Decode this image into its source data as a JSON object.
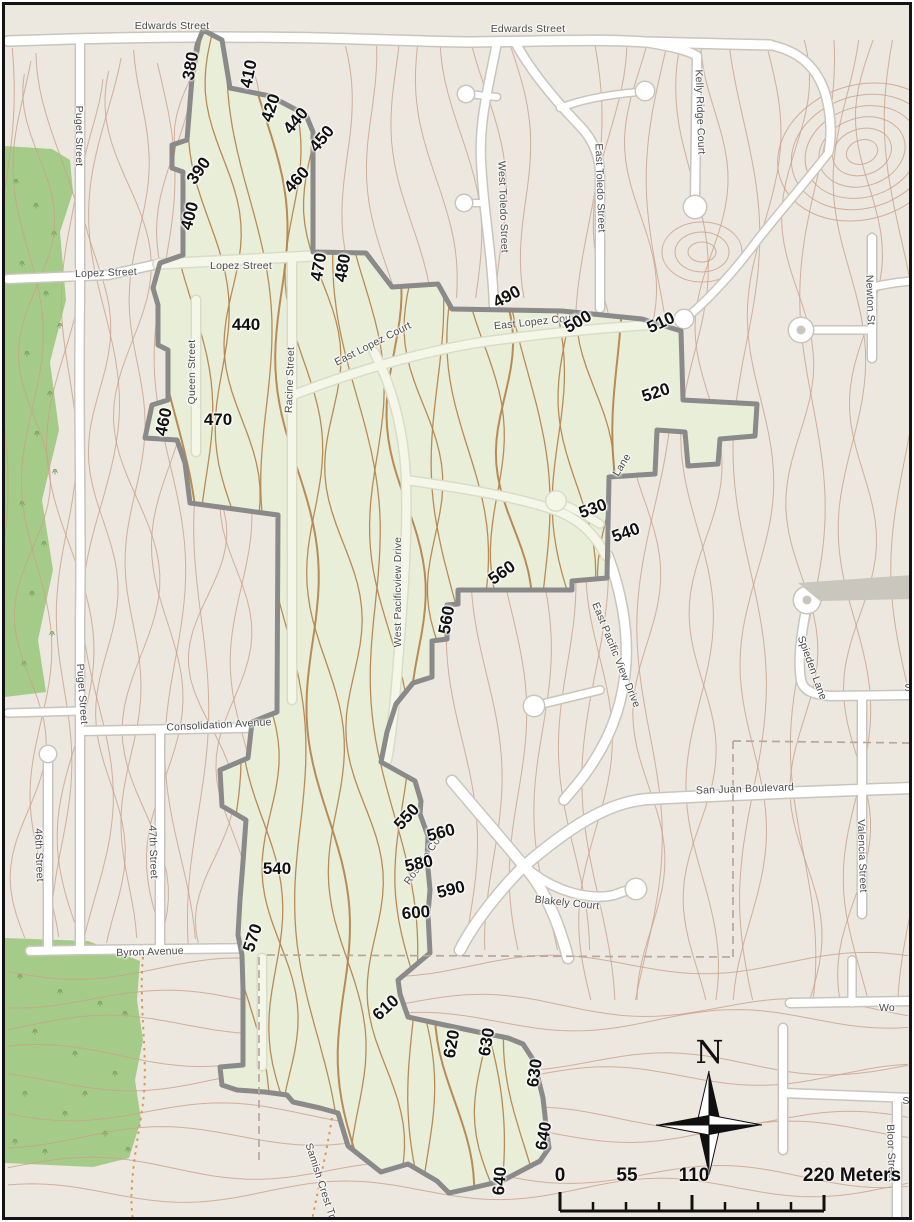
{
  "north_arrow": {
    "label": "N"
  },
  "scale_bar": {
    "labels": [
      "0",
      "55",
      "110",
      "220 Meters"
    ]
  },
  "streets": [
    {
      "text": "Edwards Street",
      "x": 172,
      "y": 26,
      "r": 0
    },
    {
      "text": "Edwards Street",
      "x": 528,
      "y": 29,
      "r": 0
    },
    {
      "text": "Puget Street",
      "x": 79,
      "y": 136,
      "r": 90
    },
    {
      "text": "Puget Street",
      "x": 82,
      "y": 694,
      "r": 86
    },
    {
      "text": "Lopez Street",
      "x": 106,
      "y": 273,
      "r": -2
    },
    {
      "text": "Lopez Street",
      "x": 241,
      "y": 266,
      "r": 0
    },
    {
      "text": "Queen Street",
      "x": 192,
      "y": 372,
      "r": -90
    },
    {
      "text": "Racine Street",
      "x": 290,
      "y": 380,
      "r": -88
    },
    {
      "text": "East Lopez Court",
      "x": 373,
      "y": 344,
      "r": -27
    },
    {
      "text": "East Lopez Court",
      "x": 536,
      "y": 322,
      "r": -6
    },
    {
      "text": "West Toledo Street",
      "x": 503,
      "y": 207,
      "r": 88
    },
    {
      "text": "East Toledo Street",
      "x": 600,
      "y": 188,
      "r": 88
    },
    {
      "text": "Kelly Ridge Court",
      "x": 700,
      "y": 112,
      "r": 88
    },
    {
      "text": "Newton St",
      "x": 870,
      "y": 300,
      "r": 88
    },
    {
      "text": "West Pacificview Drive",
      "x": 398,
      "y": 592,
      "r": -90
    },
    {
      "text": "East Pacific View Drive",
      "x": 616,
      "y": 655,
      "r": 68
    },
    {
      "text": "Spieden Lane",
      "x": 812,
      "y": 668,
      "r": 70
    },
    {
      "text": "Lane",
      "x": 622,
      "y": 465,
      "r": -58
    },
    {
      "text": "Consolidation Avenue",
      "x": 219,
      "y": 725,
      "r": -3
    },
    {
      "text": "San Juan Boulevard",
      "x": 745,
      "y": 789,
      "r": -2
    },
    {
      "text": "Valencia Street",
      "x": 862,
      "y": 856,
      "r": 88
    },
    {
      "text": "46th Street",
      "x": 39,
      "y": 855,
      "r": 88
    },
    {
      "text": "47th Street",
      "x": 153,
      "y": 852,
      "r": 88
    },
    {
      "text": "Byron Avenue",
      "x": 150,
      "y": 952,
      "r": -2
    },
    {
      "text": "Blakely Court",
      "x": 567,
      "y": 903,
      "r": 6
    },
    {
      "text": "Rosario Court",
      "x": 426,
      "y": 856,
      "r": -55
    },
    {
      "text": "Samish Crest Trail",
      "x": 322,
      "y": 1186,
      "r": 72
    },
    {
      "text": "Wo",
      "x": 887,
      "y": 1008,
      "r": 0
    },
    {
      "text": "S",
      "x": 908,
      "y": 688,
      "r": 0
    },
    {
      "text": "S",
      "x": 906,
      "y": 1101,
      "r": 0
    },
    {
      "text": "Bloor Street",
      "x": 891,
      "y": 1153,
      "r": 88
    }
  ],
  "elevations": [
    {
      "text": "380",
      "x": 191,
      "y": 66,
      "r": -80
    },
    {
      "text": "410",
      "x": 249,
      "y": 74,
      "r": -78
    },
    {
      "text": "420",
      "x": 271,
      "y": 108,
      "r": -72
    },
    {
      "text": "440",
      "x": 296,
      "y": 121,
      "r": -50
    },
    {
      "text": "450",
      "x": 322,
      "y": 139,
      "r": -50
    },
    {
      "text": "390",
      "x": 199,
      "y": 171,
      "r": -55
    },
    {
      "text": "460",
      "x": 297,
      "y": 180,
      "r": -48
    },
    {
      "text": "400",
      "x": 190,
      "y": 216,
      "r": -75
    },
    {
      "text": "470",
      "x": 319,
      "y": 267,
      "r": -80
    },
    {
      "text": "480",
      "x": 343,
      "y": 268,
      "r": -80
    },
    {
      "text": "440",
      "x": 246,
      "y": 325,
      "r": 0
    },
    {
      "text": "460",
      "x": 164,
      "y": 422,
      "r": -78
    },
    {
      "text": "470",
      "x": 218,
      "y": 420,
      "r": 0
    },
    {
      "text": "490",
      "x": 507,
      "y": 297,
      "r": -28
    },
    {
      "text": "500",
      "x": 578,
      "y": 322,
      "r": -30
    },
    {
      "text": "510",
      "x": 661,
      "y": 323,
      "r": -25
    },
    {
      "text": "520",
      "x": 656,
      "y": 393,
      "r": -18
    },
    {
      "text": "530",
      "x": 593,
      "y": 509,
      "r": -20
    },
    {
      "text": "540",
      "x": 626,
      "y": 533,
      "r": -20
    },
    {
      "text": "560",
      "x": 502,
      "y": 573,
      "r": -35
    },
    {
      "text": "560",
      "x": 447,
      "y": 620,
      "r": -80
    },
    {
      "text": "550",
      "x": 407,
      "y": 817,
      "r": -48
    },
    {
      "text": "560",
      "x": 441,
      "y": 833,
      "r": -15
    },
    {
      "text": "580",
      "x": 419,
      "y": 864,
      "r": -12
    },
    {
      "text": "590",
      "x": 451,
      "y": 890,
      "r": -14
    },
    {
      "text": "600",
      "x": 416,
      "y": 913,
      "r": -5
    },
    {
      "text": "540",
      "x": 277,
      "y": 869,
      "r": 0
    },
    {
      "text": "570",
      "x": 253,
      "y": 938,
      "r": -72
    },
    {
      "text": "610",
      "x": 386,
      "y": 1008,
      "r": -42
    },
    {
      "text": "620",
      "x": 452,
      "y": 1044,
      "r": -80
    },
    {
      "text": "630",
      "x": 487,
      "y": 1042,
      "r": -80
    },
    {
      "text": "630",
      "x": 535,
      "y": 1073,
      "r": -82
    },
    {
      "text": "640",
      "x": 544,
      "y": 1136,
      "r": -80
    },
    {
      "text": "640",
      "x": 500,
      "y": 1181,
      "r": -85
    }
  ],
  "colors": {
    "background": "#ece7df",
    "study_area_fill": "#e9eed8",
    "study_area_border": "#8a8a8a",
    "contour_outside": "#c9a188",
    "contour_inside": "#b5854f",
    "forest": "#a5cb89",
    "tree_symbol": "#7ea05e",
    "road_fill": "#ffffff",
    "road_casing": "#c9c5bc",
    "inner_road_fill": "#f4f6e8",
    "inner_road_casing": "#d9dcc9",
    "gray_lot": "#c9c6bd",
    "dashed_boundary": "#b9a79e",
    "trail_dotted": "#dd9757",
    "street_label": "#4b4b4b",
    "elevation_label": "#111111"
  }
}
